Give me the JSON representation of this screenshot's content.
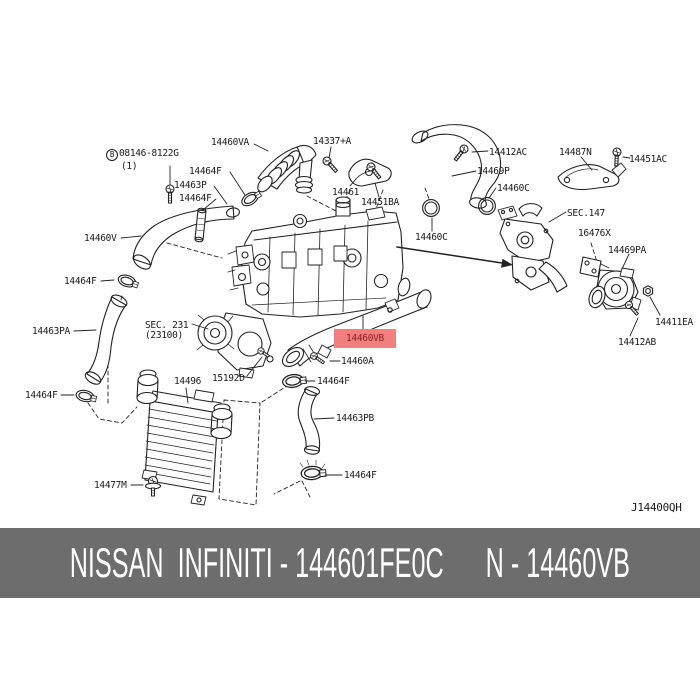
{
  "diagram": {
    "ref_code": "J14400QH",
    "bolt_ref": {
      "circled_letter": "B",
      "code": "08146-8122G",
      "qty": "(1)"
    },
    "highlight": {
      "text": "14460VB",
      "bg": "#f08080",
      "fg": "#8b1f1f"
    },
    "labels": [
      {
        "text": "14460VA"
      },
      {
        "text": "14337+A"
      },
      {
        "text": "14464F"
      },
      {
        "text": "14463P"
      },
      {
        "text": "14464F"
      },
      {
        "text": "14461"
      },
      {
        "text": "14451BA"
      },
      {
        "text": "14412AC"
      },
      {
        "text": "14469P"
      },
      {
        "text": "14487N"
      },
      {
        "text": "14451AC"
      },
      {
        "text": "14460C"
      },
      {
        "text": "SEC.147"
      },
      {
        "text": "16476X"
      },
      {
        "text": "14469PA"
      },
      {
        "text": "14460V"
      },
      {
        "text": "14464F"
      },
      {
        "text": "14463PA"
      },
      {
        "text": "SEC. 231"
      },
      {
        "text": "(23100)"
      },
      {
        "text": "14460C"
      },
      {
        "text": "14460A"
      },
      {
        "text": "15192D"
      },
      {
        "text": "14464F"
      },
      {
        "text": "14464F"
      },
      {
        "text": "14496"
      },
      {
        "text": "14463PB"
      },
      {
        "text": "14464F"
      },
      {
        "text": "14477M"
      },
      {
        "text": "14411EA"
      },
      {
        "text": "14412AB"
      }
    ]
  },
  "footer": {
    "text": "NISSAN  INFINITI - 144601FE0C      N - 14460VB",
    "bg": "#6d6d6d",
    "fg": "#ffffff"
  }
}
